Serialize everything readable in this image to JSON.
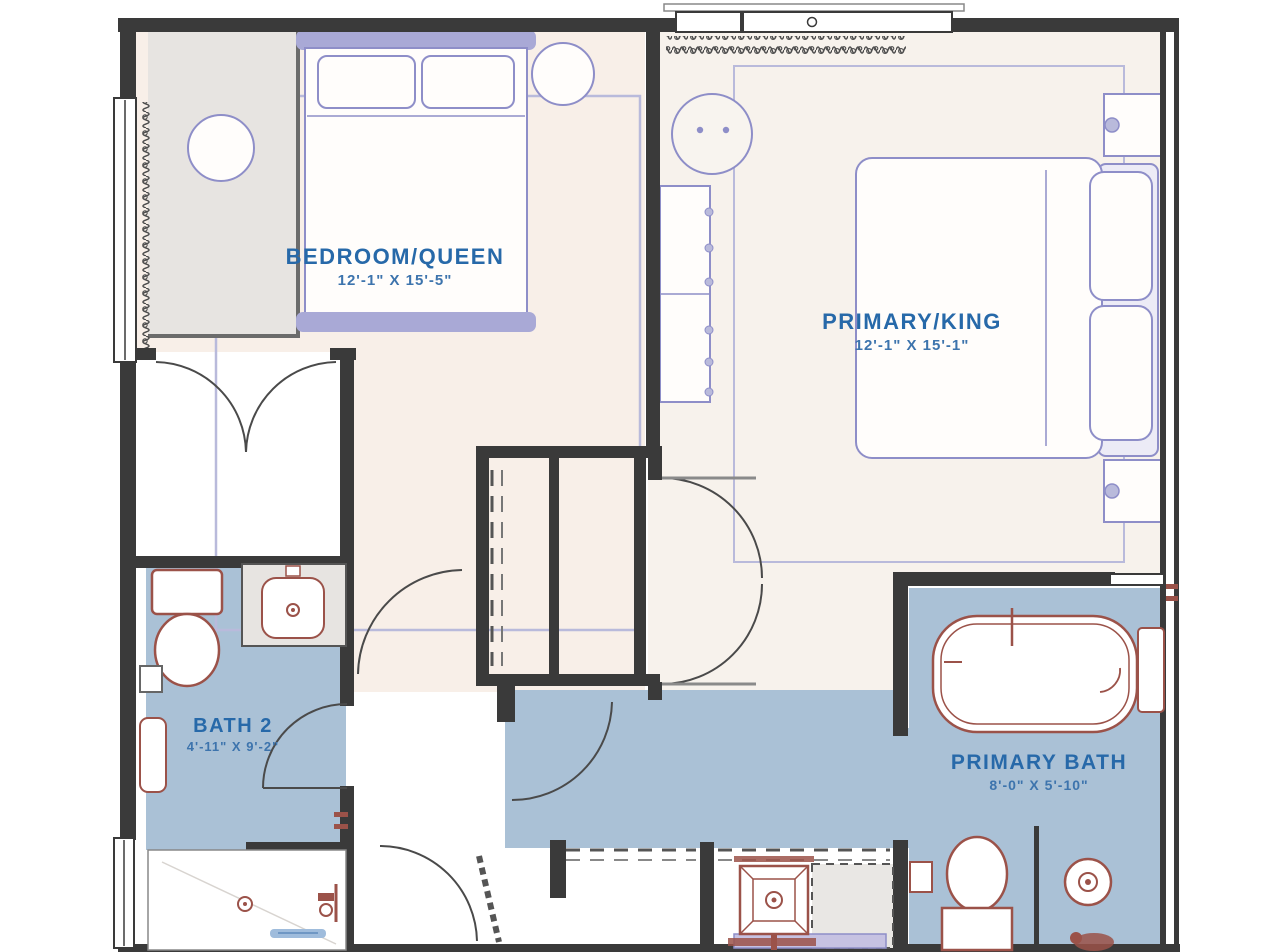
{
  "plan": {
    "rooms": [
      {
        "name": "BEDROOM/QUEEN",
        "dims": "12'-1\" X 15'-5\""
      },
      {
        "name": "PRIMARY/KING",
        "dims": "12'-1\" X 15'-1\""
      },
      {
        "name": "BATH 2",
        "dims": "4'-11\" X 9'-2\""
      },
      {
        "name": "PRIMARY BATH",
        "dims": "8'-0\" X 5'-10\""
      }
    ],
    "colors": {
      "bedroom_floor": "#f8efe8",
      "primary_floor": "#f7f2ec",
      "bath_floor": "#aac1d6",
      "closet_gray": "#e7e4e1",
      "wall": "#3a3a3a",
      "furniture_purple": "#8e8ec8",
      "furniture_solid": "#a9a9d6",
      "fixture_maroon": "#9b5249",
      "label_blue": "#2769a9",
      "rug_purple": "#b9badb",
      "bench_lavender": "#c6c2e2"
    }
  }
}
